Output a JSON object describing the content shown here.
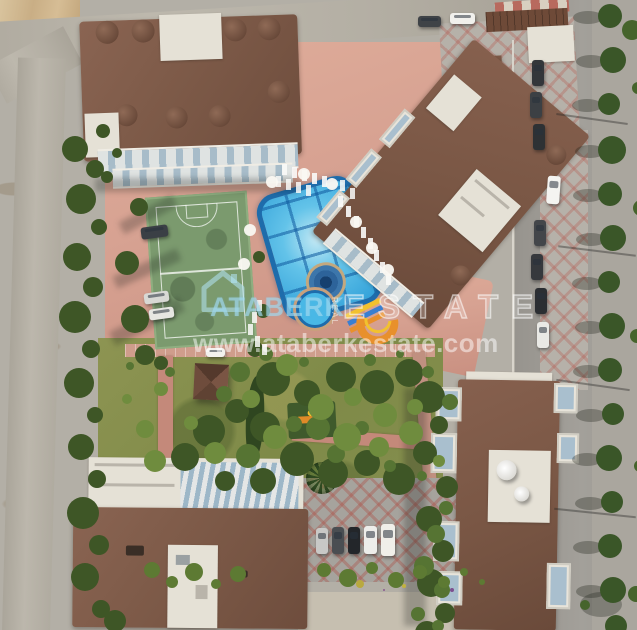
{
  "watermark": {
    "brand_primary": "ATABERK",
    "brand_secondary": "ESTATE",
    "vertical_text": "REAL",
    "website": "www.ataberkestate.com",
    "logo_icon": "house-outline-icon",
    "color_primary": "#a5dcf2",
    "color_secondary": "#ffffff"
  },
  "palette": {
    "pool_water": "#49b8e6",
    "pool_rim": "#1e6cab",
    "roof_brown": "#7d5a48",
    "deck_salmon": "#d7a292",
    "grass_green": "#879050",
    "tree_green": "#3e5626",
    "sand_beige": "#cdb28c",
    "road_gray": "#b4afa4",
    "court_green": "#7b9a6e",
    "slide_orange": "#e8902c",
    "pavement_diamond_red": "#b05a50"
  }
}
